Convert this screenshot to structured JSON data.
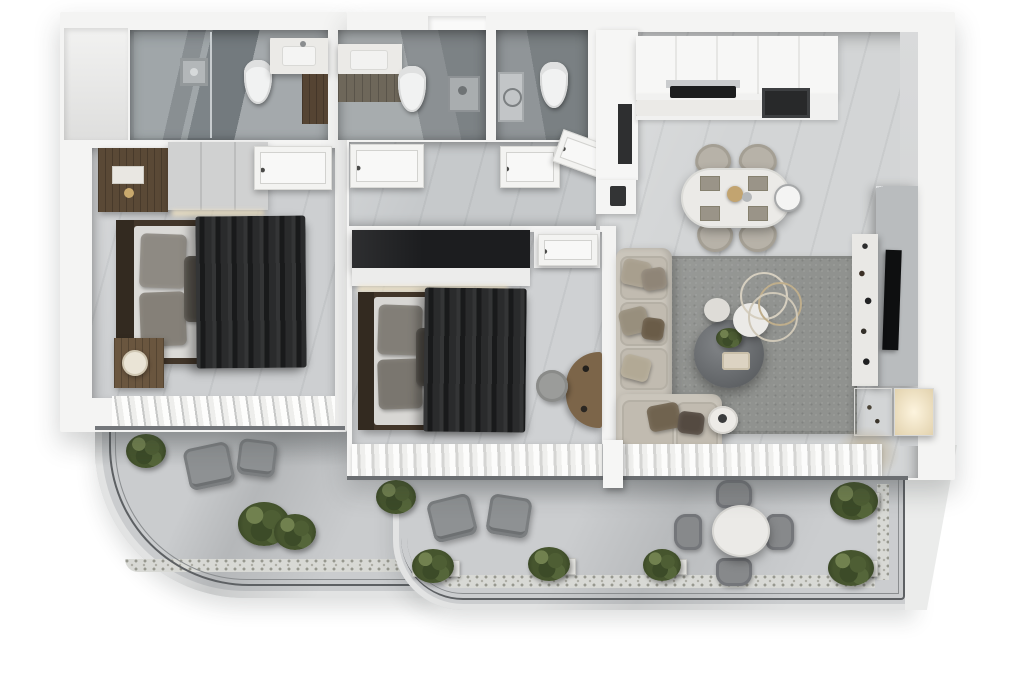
{
  "scene": {
    "title": "Top-down 3D apartment floor plan render",
    "style": "photorealistic monochrome grey and white dollhouse view",
    "view": "orthographic top-down"
  },
  "palette": {
    "background": "#ffffff",
    "walls": "#f4f4f3",
    "floor_living": "#d3d5d6",
    "floor_bedroom": "#cdcfd1",
    "floor_bathroom": "#8f9699",
    "balcony_floor": "#cbcdcf",
    "railing": "#5d6063",
    "rug": "#90928f",
    "sofa": "#cac5bb",
    "wood_dark": "#5a4936",
    "bedding_dark": "#232425",
    "marble_white": "#ebeae7",
    "greenery": "#46552e",
    "accent_brass": "#c2a470"
  },
  "rooms": [
    {
      "id": "master-bedroom",
      "name": "Master bedroom",
      "furniture": [
        "double bed with dark throw",
        "grey wardrobe",
        "dark wood dresser",
        "nightstand with lamp",
        "louvered window"
      ]
    },
    {
      "id": "second-bedroom",
      "name": "Second bedroom",
      "furniture": [
        "double bed with dark throw",
        "black wardrobe",
        "white closet",
        "dressing desk",
        "round stool",
        "sheer curtains"
      ]
    },
    {
      "id": "ensuite-bathroom",
      "name": "En-suite bathroom",
      "furniture": [
        "walk-in glass shower",
        "wall-hung toilet",
        "marble vanity with sink"
      ]
    },
    {
      "id": "family-bathroom",
      "name": "Family bathroom",
      "furniture": [
        "vanity with sink and mirror",
        "wall-hung toilet",
        "shower fitting"
      ]
    },
    {
      "id": "guest-wc",
      "name": "Guest WC",
      "furniture": [
        "wall-hung toilet",
        "utility column"
      ]
    },
    {
      "id": "hallway",
      "name": "Hallway",
      "furniture": [
        "white panel door",
        "white panel door"
      ]
    },
    {
      "id": "entrance",
      "name": "Entrance foyer",
      "furniture": [
        "entry door ajar",
        "tall storage unit"
      ]
    },
    {
      "id": "kitchen",
      "name": "Kitchen",
      "furniture": [
        "white upper cabinets",
        "counter with marble splashback",
        "black cooktop with hood",
        "built-in oven",
        "lower counter run"
      ]
    },
    {
      "id": "dining-area",
      "name": "Dining area",
      "furniture": [
        "oval marble dining table",
        "four upholstered chairs",
        "place settings",
        "brass centerpiece",
        "wall clock"
      ]
    },
    {
      "id": "living-room",
      "name": "Living room",
      "furniture": [
        "L-shaped beige sofa",
        "textured grey rug",
        "large round coffee table with plant",
        "white marble side tables",
        "metal ring decor",
        "marble TV feature wall",
        "wall TV",
        "display console with objects",
        "back-lit shelving",
        "dried grass arrangement"
      ]
    },
    {
      "id": "bedroom-terrace",
      "name": "Bedroom terrace",
      "furniture": [
        "two grey lounge chairs",
        "box planting",
        "curved glass railing",
        "pebble border"
      ]
    },
    {
      "id": "living-terrace",
      "name": "Living terrace",
      "furniture": [
        "two grey lounge chairs",
        "round marble bistro table",
        "four terrace chairs",
        "box planters",
        "glass railing",
        "pebble border"
      ]
    }
  ]
}
